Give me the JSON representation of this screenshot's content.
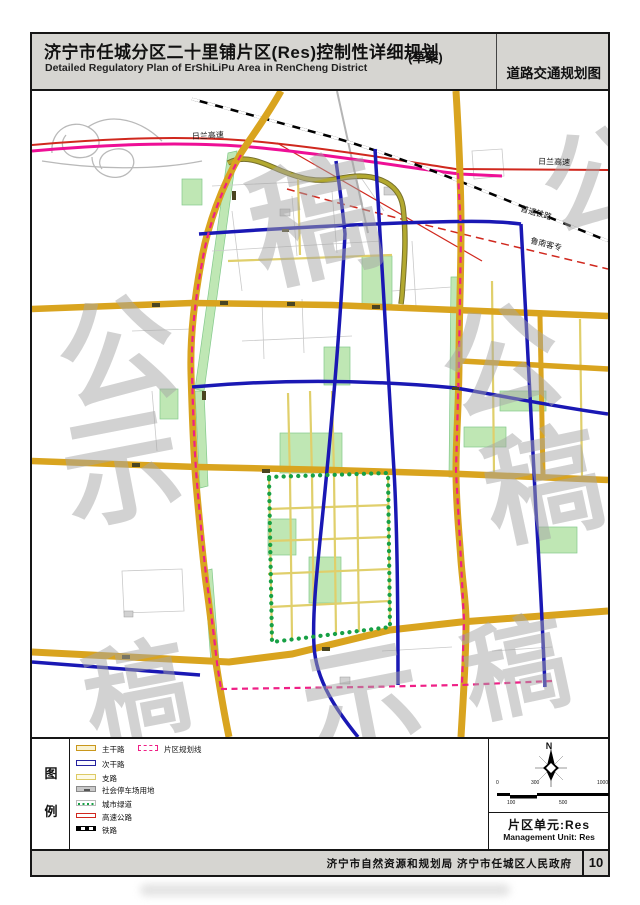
{
  "header": {
    "title_cn": "济宁市任城分区二十里铺片区(Res)控制性详细规划",
    "title_draft": "(草案)",
    "title_en": "Detailed Regulatory Plan of ErShiLiPu Area in RenCheng District",
    "map_type": "道路交通规划图"
  },
  "map": {
    "labels": {
      "expressway_left": "日兰高速",
      "expressway_right": "日兰高速",
      "railway": "普通铁路",
      "hsr": "鲁南客专"
    },
    "watermark": {
      "text": "公示稿",
      "chars": [
        "公",
        "示",
        "稿"
      ]
    },
    "colors": {
      "main_road": "#d9a41f",
      "secondary_road": "#1a18b4",
      "branch_road": "#e0cf6b",
      "expressway_red": "#d0281e",
      "expressway_magenta": "#ee0f96",
      "district_boundary": "#ef1f86",
      "greenway_dots": "#17a045",
      "green_space": "#bfe7b4",
      "railway": "#000000"
    }
  },
  "legend": {
    "box_chars": [
      "图",
      "例"
    ],
    "items": [
      {
        "label": "主干路",
        "type": "main-road"
      },
      {
        "label": "次干路",
        "type": "secondary-road"
      },
      {
        "label": "支路",
        "type": "branch-road"
      },
      {
        "label": "社会停车场用地",
        "type": "parking"
      },
      {
        "label": "城市绿道",
        "type": "greenway"
      },
      {
        "label": "高速公路",
        "type": "expressway"
      },
      {
        "label": "铁路",
        "type": "railway"
      }
    ],
    "col2": [
      {
        "label": "片区规划线",
        "type": "district-boundary"
      }
    ]
  },
  "map_info": {
    "north_label": "N",
    "scale_top": [
      "0",
      "300",
      "1000"
    ],
    "scale_bottom": [
      "100",
      "500"
    ],
    "unit_cn": "片区单元:Res",
    "unit_en": "Management Unit: Res"
  },
  "footer": {
    "agency": "济宁市自然资源和规划局 济宁市任城区人民政府",
    "page": "10"
  }
}
